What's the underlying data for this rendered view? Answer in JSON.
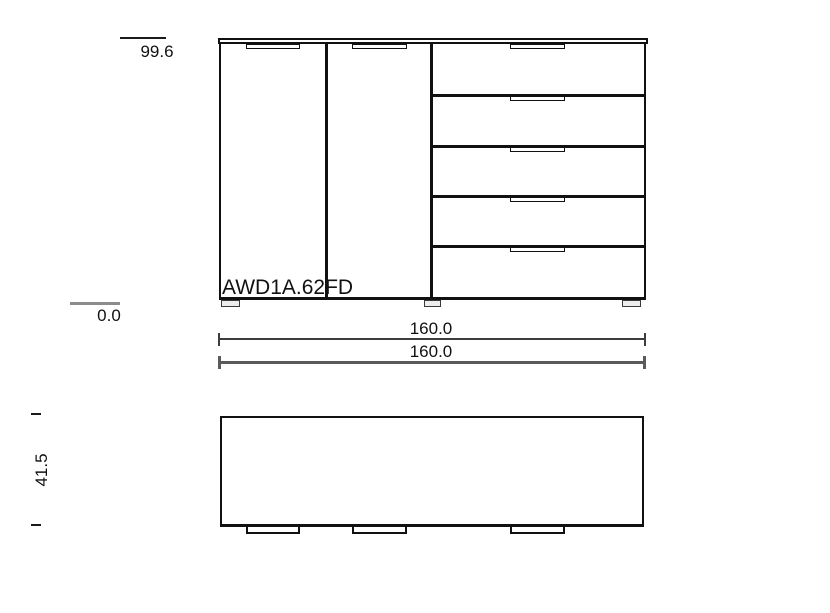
{
  "drawing": {
    "model_label": "AWD1A.62FD",
    "annotations": {
      "height_top": "99.6",
      "height_baseline": "0.0",
      "width_primary": "160.0",
      "width_secondary": "160.0",
      "depth": "41.5"
    },
    "structure": {
      "views": [
        "front-elevation",
        "plan-top-view"
      ],
      "doors": 2,
      "drawers": 5,
      "door_handles": 2,
      "drawer_handles": 5,
      "feet": 3,
      "plan_handle_tabs": 3
    },
    "colors": {
      "line": "#111111",
      "dim_line_primary": "#3d3d3d",
      "dim_line_secondary": "#5a5a5a",
      "baseline_gray": "#8c8c8c",
      "text": "#111111",
      "background": "#ffffff"
    }
  }
}
